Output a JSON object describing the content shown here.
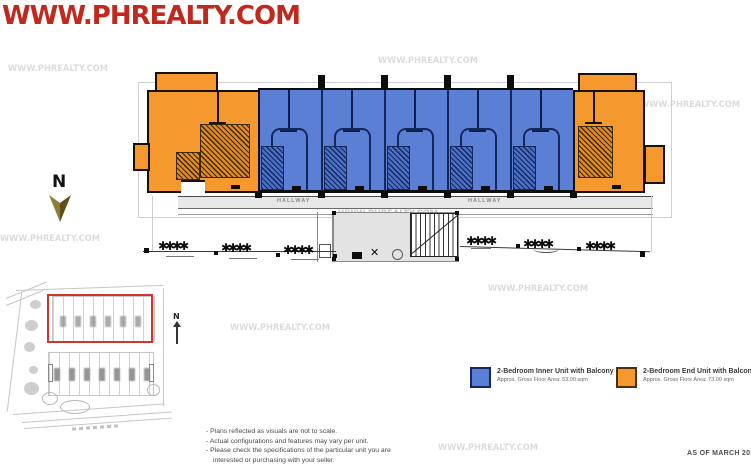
{
  "watermarks": {
    "header_text": "WWW.PHREALTY.COM",
    "tile_text": "WWW.PHREALTY.COM",
    "header_color": "#c02a1e",
    "tile_color": "#dcdcdc"
  },
  "plan": {
    "hallway_label": "HALLWAY",
    "north_label": "N",
    "tree_group_glyphs": "✱✱✱✱",
    "colors": {
      "inner_unit_fill": "#5b7fd4",
      "end_unit_fill": "#f5992e",
      "unit_outline": "#14285a",
      "site_highlight_red": "#cc352b"
    }
  },
  "legend": {
    "items": [
      {
        "label": "2-Bedroom Inner Unit with Balcony",
        "sublabel": "Approx. Gross Floor Area: 53.00 sqm",
        "swatch_color": "#5b7fd4"
      },
      {
        "label": "2-Bedroom End Unit with Balcony",
        "sublabel": "Approx. Gross Floor Area: 73.00 sqm",
        "swatch_color": "#f5992e"
      }
    ]
  },
  "notes": {
    "lines": [
      "- Plans reflected as visuals are not to scale.",
      "- Actual configurations and features may vary per unit.",
      "- Please check the specifications of the particular unit you are",
      "interested or purchasing with your seller."
    ]
  },
  "footer": {
    "as_of": "AS OF MARCH 2015"
  }
}
